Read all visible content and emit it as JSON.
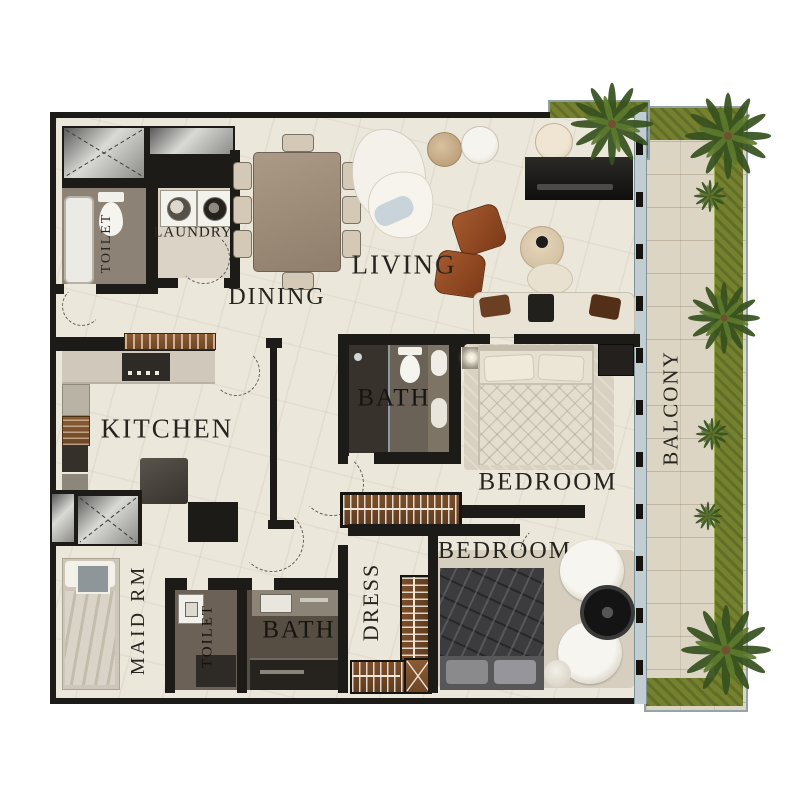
{
  "plan": {
    "rooms": {
      "toilet_upper": {
        "label": "TOILET",
        "orientation": "vertical"
      },
      "laundry": {
        "label": "LAUNDRY",
        "orientation": "horizontal"
      },
      "dining": {
        "label": "DINING",
        "orientation": "horizontal"
      },
      "living": {
        "label": "LIVING",
        "orientation": "horizontal"
      },
      "kitchen": {
        "label": "KITCHEN",
        "orientation": "horizontal"
      },
      "bath_main": {
        "label": "BATH",
        "orientation": "horizontal"
      },
      "bedroom_main": {
        "label": "BEDROOM",
        "orientation": "horizontal"
      },
      "balcony": {
        "label": "BALCONY",
        "orientation": "vertical"
      },
      "maid_room": {
        "label": "MAID RM",
        "orientation": "vertical"
      },
      "toilet_lower": {
        "label": "TOILET",
        "orientation": "vertical"
      },
      "bath_lower": {
        "label": "BATH",
        "orientation": "horizontal"
      },
      "dress": {
        "label": "DRESS",
        "orientation": "vertical"
      },
      "bedroom_lower": {
        "label": "BEDROOM",
        "orientation": "horizontal"
      }
    },
    "colors": {
      "wall": "#1d1b18",
      "floor_marble": "#ece7db",
      "bath_dark": "#6a6157",
      "balcony_wood": "#ddd5c4",
      "planter_green": "#76812f",
      "palm_green": "#36511f",
      "wood_accent": "#6e4526",
      "leather_chair": "#9c512a",
      "label_text": "#26241f",
      "glass": "#c2cdd2"
    },
    "icons": {
      "palm-tree-icon": "radial green fronds",
      "washer-icon": "square with circular door",
      "dryer-icon": "square with circular door",
      "toilet-icon": "oval bowl with tank",
      "bathtub-icon": "rounded rectangle",
      "sink-icon": "rounded basin",
      "bed-icon": "mattress with pillows",
      "sofa-icon": "rounded seat block",
      "armchair-icon": "leather rounded square",
      "dining-table-icon": "rectangle with 8 chairs",
      "wardrobe-icon": "wood bar with hangers",
      "stove-icon": "dark block with burners",
      "door-swing-icon": "dashed quarter arc",
      "planter-icon": "green strip",
      "tv-console-icon": "dark media unit",
      "coffee-table-icon": "round table",
      "kitchen-island-icon": "gray block"
    }
  }
}
